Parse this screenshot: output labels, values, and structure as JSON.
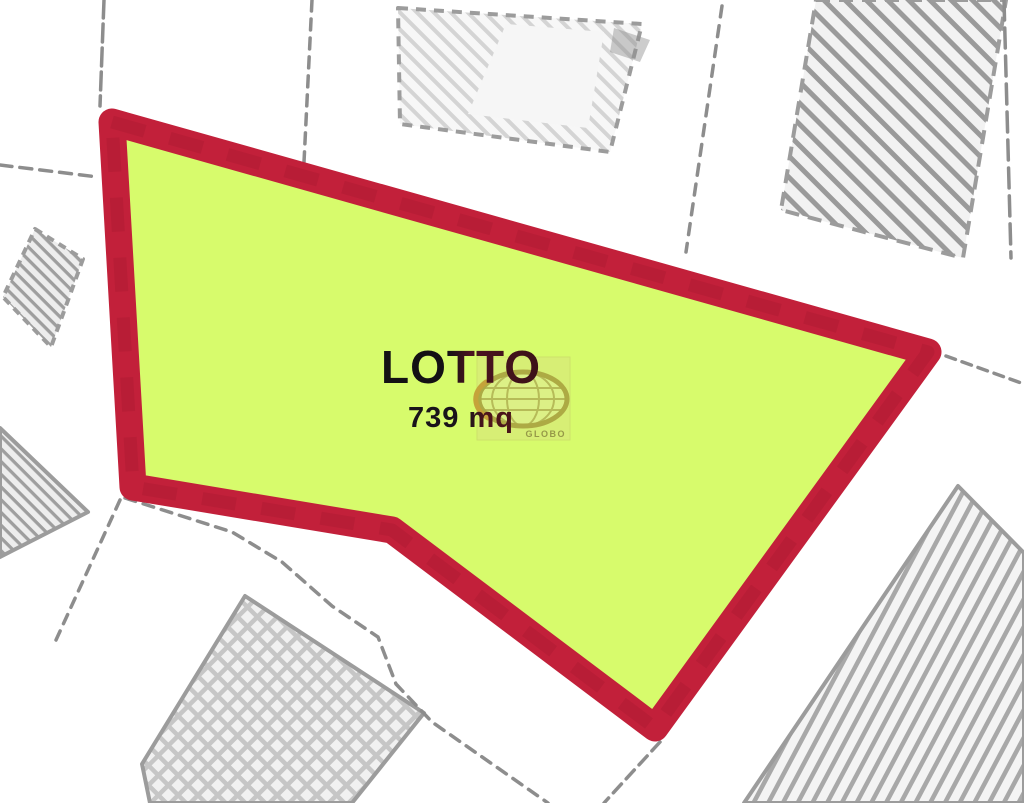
{
  "map": {
    "lot_label": "LOTTO",
    "lot_area": "739 mq",
    "watermark_text": "GLOBO"
  },
  "colors": {
    "background": "#ffffff",
    "lot_fill": "#d7fb6c",
    "lot_border": "#c2203a",
    "sketch_gray": "#8d8d8d",
    "watermark_box": "#d8e97a",
    "watermark_ring": "#a9a240",
    "watermark_gold": "#c49a35",
    "label_color": "#141114"
  }
}
